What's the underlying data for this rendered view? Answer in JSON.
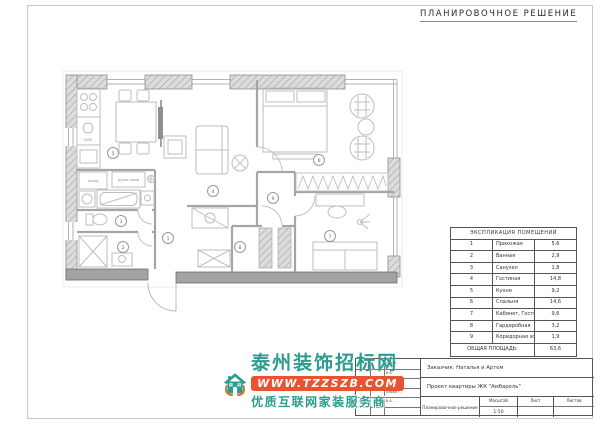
{
  "page": {
    "title": "ПЛАНИРОВОЧНОЕ РЕШЕНИЕ"
  },
  "plan": {
    "rooms": [
      {
        "number": "1"
      },
      {
        "number": "2"
      },
      {
        "number": "3"
      },
      {
        "number": "4"
      },
      {
        "number": "5"
      },
      {
        "number": "6"
      },
      {
        "number": "7"
      },
      {
        "number": "8"
      },
      {
        "number": "9"
      }
    ],
    "labels": {
      "fridge": "холод",
      "oven": "духов. шкаф",
      "dishwasher": "D/W"
    }
  },
  "explication": {
    "title": "ЭКСПЛИКАЦИЯ ПОМЕЩЕНИЙ",
    "rows": [
      {
        "num": "1",
        "name": "Прихожая",
        "area": "5,6"
      },
      {
        "num": "2",
        "name": "Ванная",
        "area": "2,9"
      },
      {
        "num": "3",
        "name": "Санузел",
        "area": "1,8"
      },
      {
        "num": "4",
        "name": "Гостиная",
        "area": "14,8"
      },
      {
        "num": "5",
        "name": "Кухня",
        "area": "9,2"
      },
      {
        "num": "6",
        "name": "Спальня",
        "area": "14,6"
      },
      {
        "num": "7",
        "name": "Кабинет, Гостевая, Детская",
        "area": "9,6"
      },
      {
        "num": "8",
        "name": "Гардеробная",
        "area": "3,2"
      },
      {
        "num": "9",
        "name": "Коридорная зона",
        "area": "1,9"
      }
    ],
    "total_label": "ОБЩАЯ ПЛОЩАДЬ:",
    "total_value": "63,6"
  },
  "title_block": {
    "client": "Заказчик: Наталья и Артем",
    "project": "Проект квартиры ЖК \"Амбарель\"",
    "drawing_name": "Планировочное решение",
    "scale_label": "Масштаб",
    "scale_value": "1:50",
    "sheet_label": "Лист",
    "sheets_label": "Листов",
    "signatures": [
      "нов П.",
      "б А.",
      "улова Т.",
      "улова Т.",
      "б А."
    ]
  },
  "watermark": {
    "site_name": "泰州装饰招标网",
    "url": "WWW.TZZSZB.COM",
    "tagline": "优质互联网家装服务商",
    "colors": {
      "teal": "#2b9c8f",
      "orange": "#e8542f",
      "hand_orange": "#d4752e"
    }
  }
}
